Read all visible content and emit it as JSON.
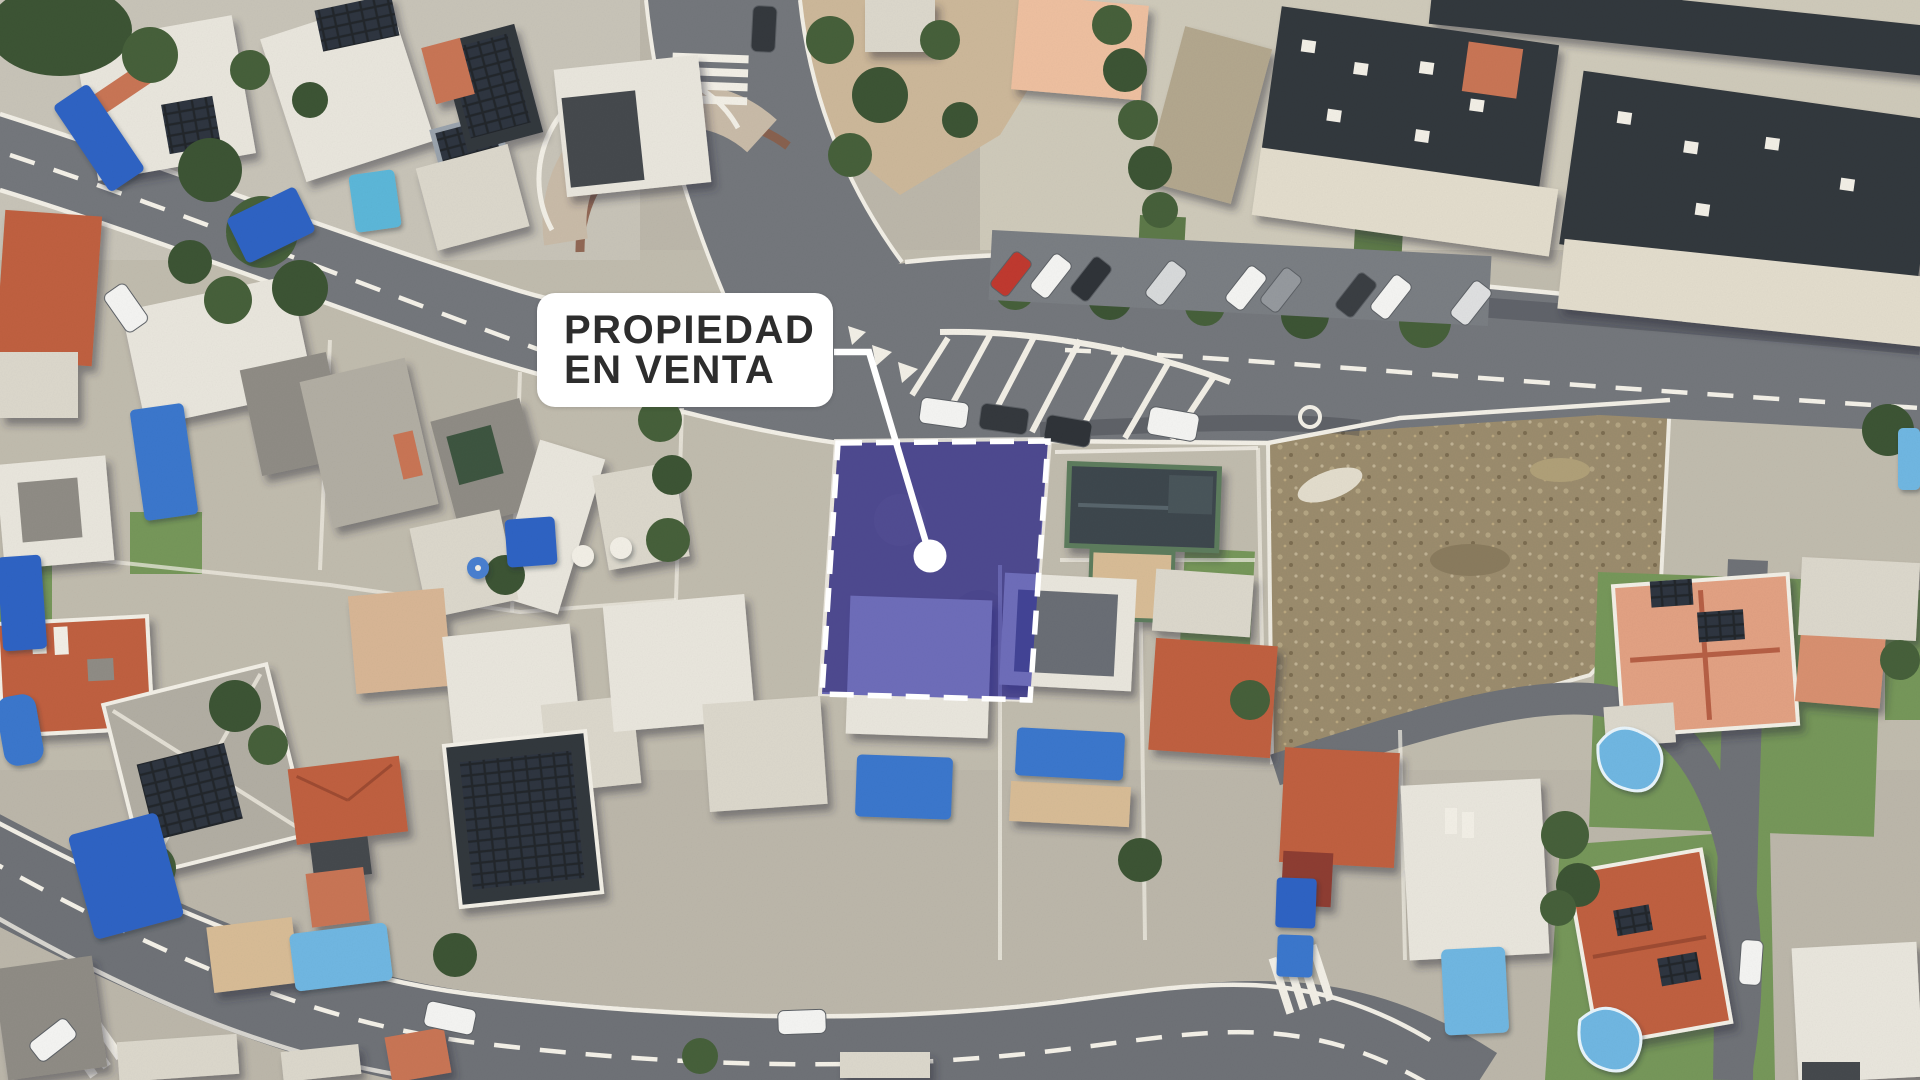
{
  "annotation": {
    "label_line1": "PROPIEDAD",
    "label_line2": "EN VENTA"
  },
  "colors": {
    "highlight_fill": "#2e2ea6",
    "highlight_stroke": "#ffffff",
    "connector": "#ffffff",
    "label_bg": "#ffffff",
    "label_text": "#2d2d2d"
  },
  "overlay_geometry": {
    "polygon_points": "838,443 1048,441 1030,700 822,694",
    "connector_points": "834,352 869,352 930,556",
    "marker_cx": "930",
    "marker_cy": "556",
    "marker_r": "16.5"
  }
}
